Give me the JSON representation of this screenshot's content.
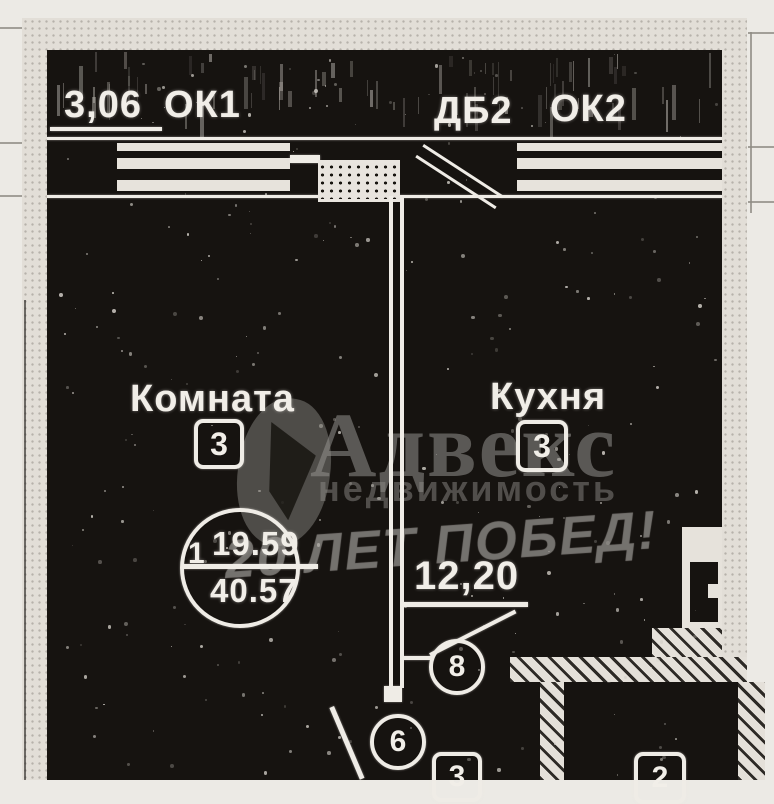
{
  "plan": {
    "balcony": {
      "dimension": "3,06",
      "window1_label": "ОК1",
      "door_label": "ДБ2",
      "window2_label": "ОК2"
    },
    "rooms": {
      "living": {
        "name": "Комната",
        "number": "3"
      },
      "kitchen": {
        "name": "Кухня",
        "number": "3"
      }
    },
    "area_stamp": {
      "rooms_count": "1",
      "living_area": "19.59",
      "total_area": "40.57"
    },
    "kitchen_dimension": "12,20",
    "callouts": {
      "kitchen_door": "8",
      "hall_door": "6",
      "hall_number": "3",
      "bath_number": "2"
    }
  },
  "watermark": {
    "brand": "Адвекс",
    "brand_sub": "недвижимость",
    "overlay": "20 ЛЕТ ПОБЕД!"
  },
  "colors": {
    "paper": "#eceae5",
    "ink_dark": "#161310",
    "line_white": "#efece6",
    "wall": "#e2ded7",
    "watermark_gray": "#8e8c88"
  }
}
